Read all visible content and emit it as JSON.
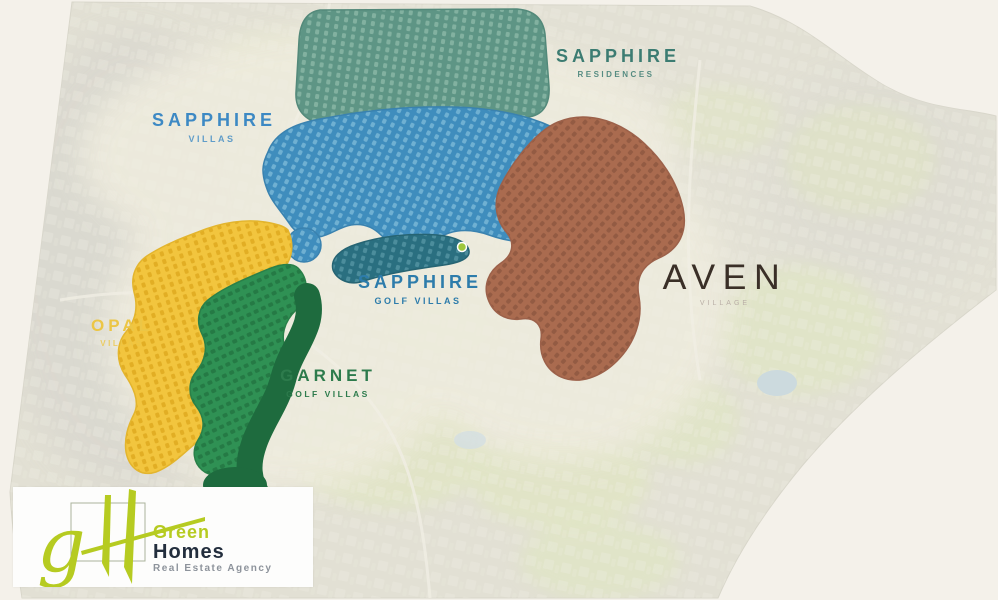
{
  "page": {
    "background": "#f4f1ea",
    "description": "Master plan map"
  },
  "map": {
    "zones": [
      {
        "id": "sapphire-residences",
        "label": "SAPPHIRE",
        "sublabel": "RESIDENCES",
        "zone_color": "#5e9585",
        "label_color": "#3c7c72"
      },
      {
        "id": "sapphire-villas",
        "label": "SAPPHIRE",
        "sublabel": "VILLAS",
        "zone_color": "#3f8dbd",
        "label_color": "#3d89c4"
      },
      {
        "id": "sapphire-golf-villas",
        "label": "SAPPHIRE",
        "sublabel": "GOLF VILLAS",
        "zone_color": "#2a6f80",
        "label_color": "#2d7cab"
      },
      {
        "id": "opal-villas",
        "label": "OPAL",
        "sublabel": "VILLAS",
        "zone_color": "#f2c53e",
        "label_color": "#ecc646"
      },
      {
        "id": "garnet-golf-villas",
        "label": "GARNET",
        "sublabel": "GOLF VILLAS",
        "zone_color": "#2f9154",
        "label_color": "#2d7b4c"
      },
      {
        "id": "aven-village",
        "label": "AVEN",
        "sublabel": "VILLAGE",
        "zone_color": "#aa6b4f",
        "label_color": "#3a2f27"
      }
    ],
    "marker_color": "#9ec73d"
  },
  "logo": {
    "monogram_g": "g",
    "monogram_h": "H",
    "name_line1": "Green",
    "name_line2": "Homes",
    "tagline": "Real Estate Agency",
    "lime": "#b6cb21",
    "navy": "#232e3d",
    "grey": "#8d939b"
  }
}
